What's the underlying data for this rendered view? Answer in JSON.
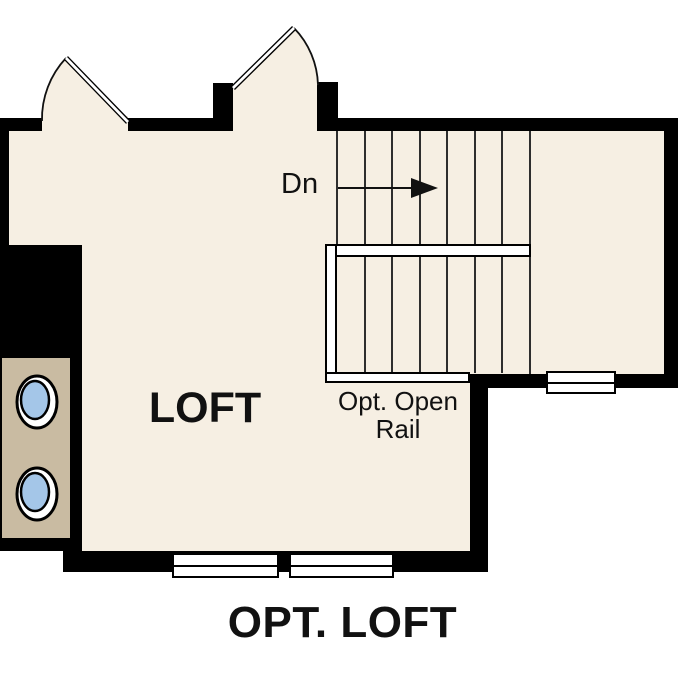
{
  "plan": {
    "title": "OPT. LOFT",
    "room_label": "LOFT",
    "stair_direction_label": "Dn",
    "rail_label_line1": "Opt. Open",
    "rail_label_line2": "Rail",
    "colors": {
      "floor": "#f6efe3",
      "wall": "#000000",
      "tan": "#c9bba2",
      "fixture_blue": "#a4c6e8",
      "stair_line": "#2e2e2e",
      "text": "#111111"
    }
  }
}
